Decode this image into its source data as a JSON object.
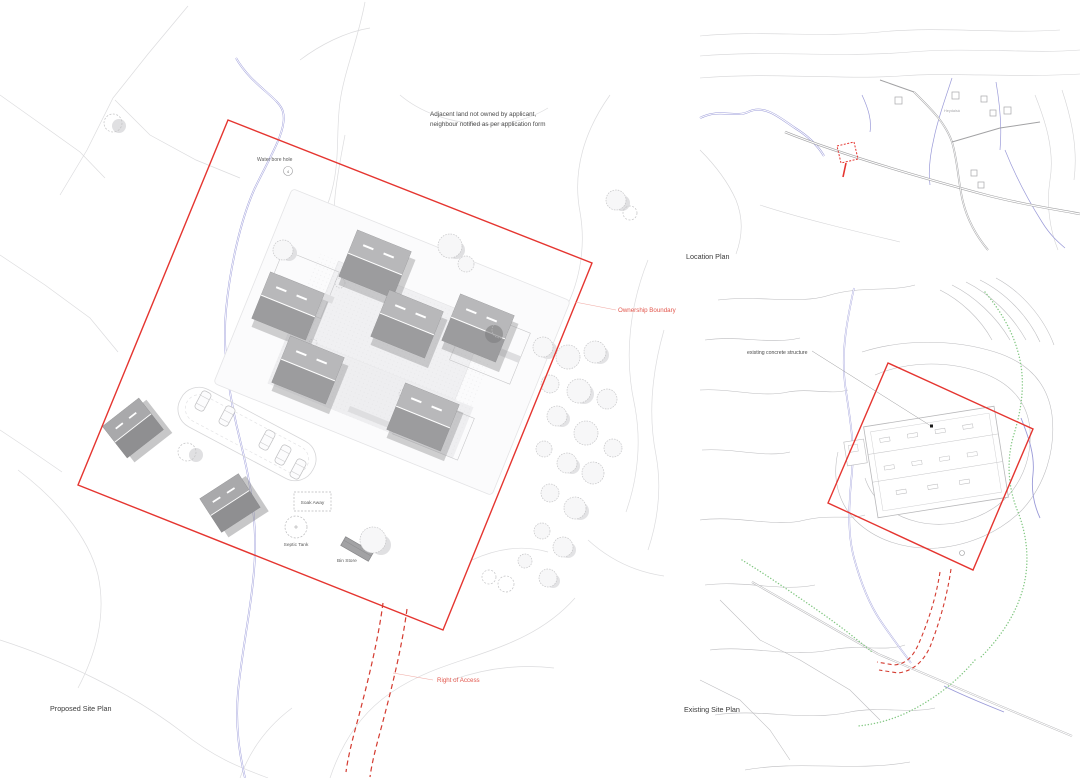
{
  "colors": {
    "boundary_red": "#e53530",
    "label_red": "#e2574d",
    "stream_blue": "#9494d6",
    "vegetation_green": "#84c884",
    "contour_gray": "#dcdcde",
    "building_gray": "#a6a6a8"
  },
  "proposed_site_plan": {
    "title": "Proposed Site Plan",
    "note": {
      "line1": "Adjacent land not owned by applicant,",
      "line2": "neighbour notified as per application form"
    },
    "labels": {
      "water_bore_hole": "Water bore hole",
      "water_bore_hole_number": "4",
      "soak_away": "Soak Away",
      "septic_tank": "Septic Tank",
      "bin_store": "Bin Store",
      "ownership_boundary": "Ownership Boundary",
      "right_of_access": "Right of Access"
    }
  },
  "location_plan": {
    "title": "Location Plan",
    "place_label": "Heydalsá"
  },
  "existing_site_plan": {
    "title": "Existing Site Plan",
    "labels": {
      "concrete_structure": "existing concrete structure"
    }
  }
}
